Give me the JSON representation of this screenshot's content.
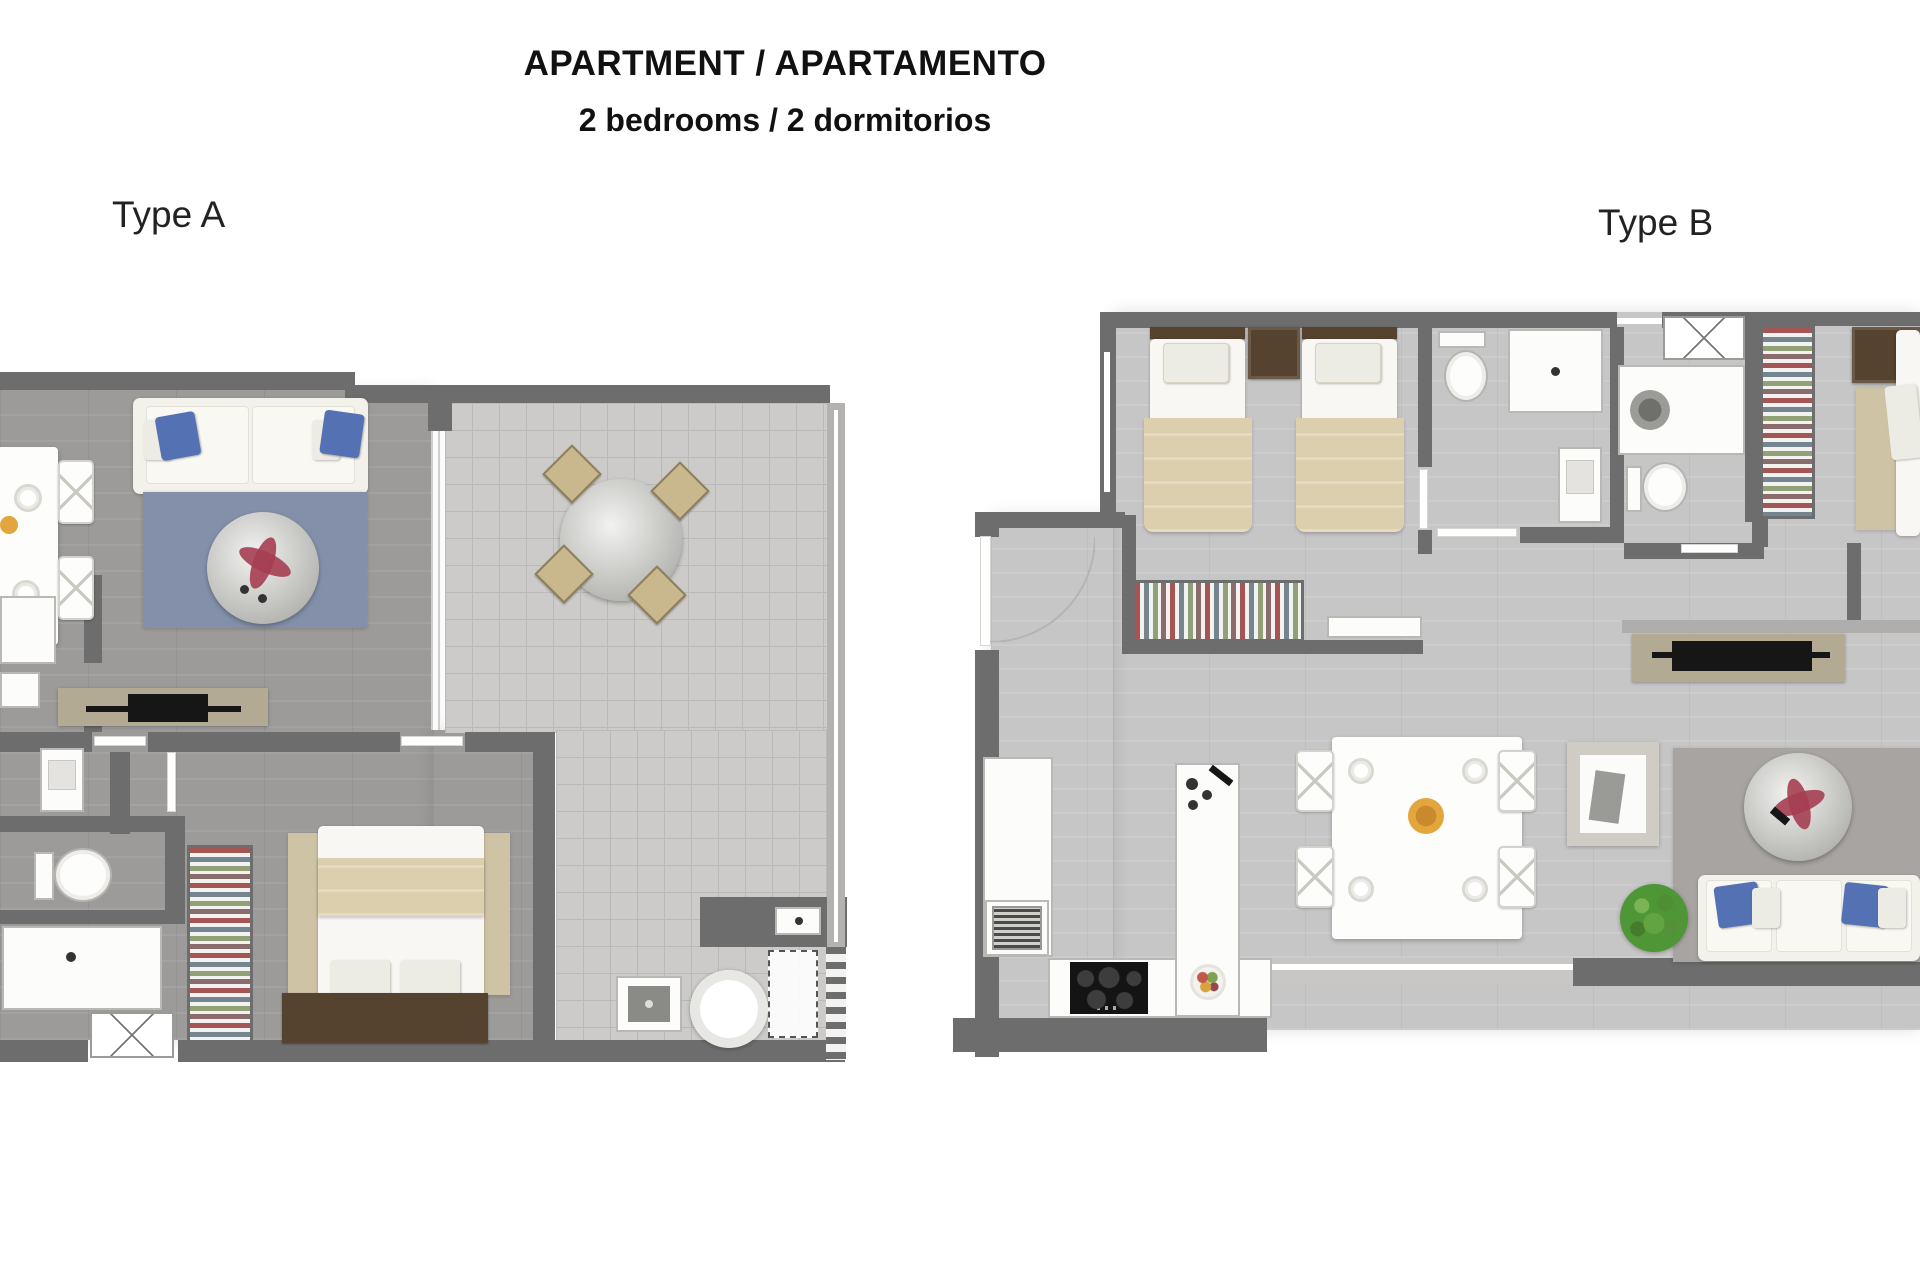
{
  "title": "APARTMENT / APARTAMENTO",
  "subtitle": "2 bedrooms / 2 dormitorios",
  "plan_a_label": "Type A",
  "plan_b_label": "Type B",
  "colors": {
    "wall": "#6d6d6d",
    "wall_light": "#b0aeac",
    "floor_a": "#9d9b99",
    "floor_b": "#c7c6c7",
    "tile": "#cccbc9",
    "tile_line": "#bab9b7",
    "rug_a": "#8490aa",
    "rug_b": "#a7a4a1",
    "rug_beige": "#cfc3a6",
    "sofa": "#f2f1ea",
    "pillow_blue": "#5471b4",
    "blanket": "#dccfae",
    "wood_dark": "#55422f",
    "console_tan": "#b2aa92",
    "tv_black": "#161616",
    "plant_green": "#4f9637",
    "flower_red": "#a53e52",
    "chair_beige": "#c9b88e",
    "cooktop": "#141414",
    "bowl_orange": "#e2a63c"
  }
}
